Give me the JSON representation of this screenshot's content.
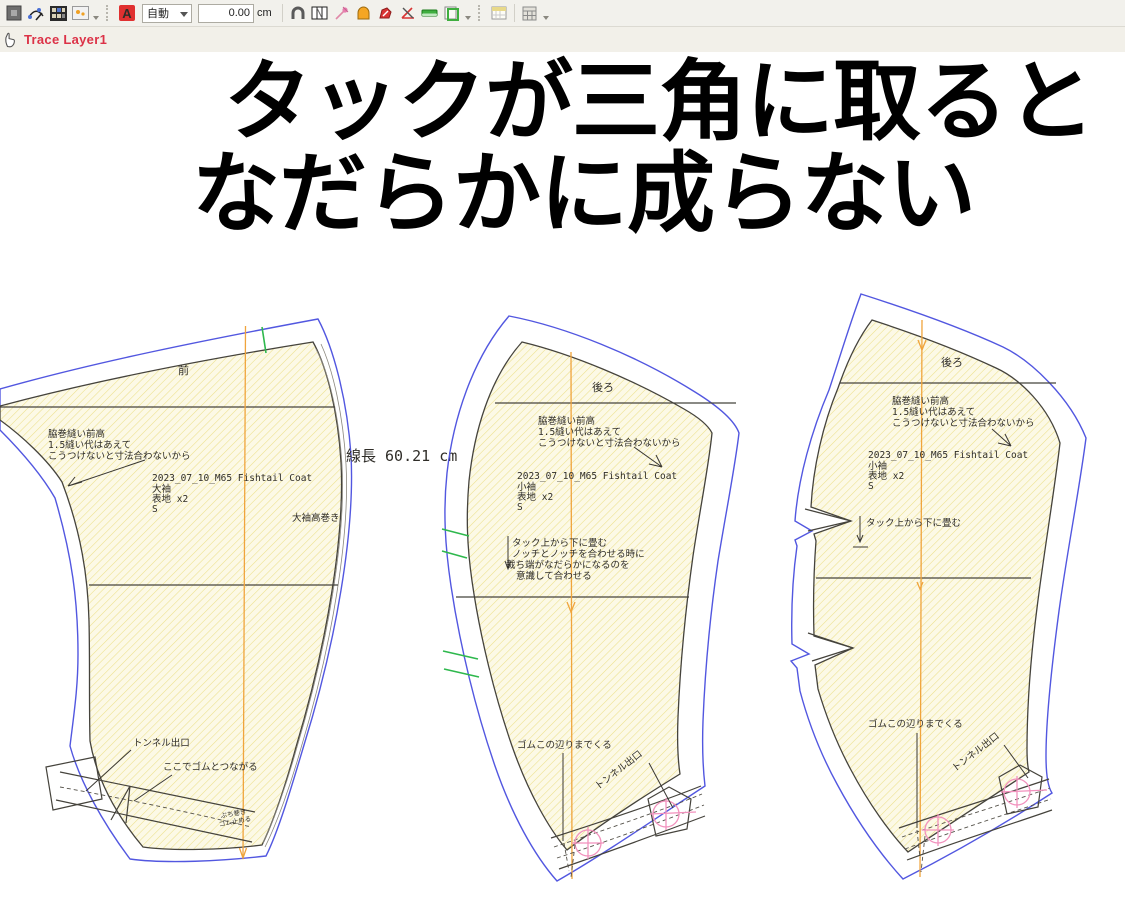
{
  "toolbar": {
    "combo_value": "自動",
    "field_value": "0.00",
    "unit": "cm",
    "icons": [
      "swatch-icon",
      "compass-icon",
      "grid-icon",
      "image-icon",
      "text-style-icon",
      "magnet-icon",
      "pleat-icon",
      "pin-icon",
      "dome-icon",
      "trace-icon",
      "angle-icon",
      "ruler-icon",
      "clipboard-icon",
      "calendar-icon",
      "calculator-icon"
    ]
  },
  "layer_bar": {
    "label": "Trace Layer1"
  },
  "caption": {
    "line1": "タックが三角に取ると",
    "line2": "なだらかに成らない"
  },
  "measurement": {
    "line_length": "線長 60.21 cm"
  },
  "pieces": {
    "piece1": {
      "part": "前",
      "note": [
        "脇巻縫い前高",
        "1.5縫い代はあえて",
        "こうつけないと寸法合わないから"
      ],
      "meta": [
        "2023_07_10_M65 Fishtail Coat",
        "大袖",
        "表地 x2",
        "S"
      ],
      "side": "大袖高巻き",
      "tunnel": "トンネル出口",
      "elastic": "ここでゴムとつながる",
      "tiny": [
        "ぶち巻き",
        "ゴム止める"
      ]
    },
    "piece2": {
      "part": "後ろ",
      "note": [
        "脇巻縫い前高",
        "1.5縫い代はあえて",
        "こうつけないと寸法合わないから"
      ],
      "meta": [
        "2023_07_10_M65 Fishtail Coat",
        "小袖",
        "表地 x2",
        "S"
      ],
      "tack": [
        "タック上から下に畳む",
        "ノッチとノッチを合わせる時に",
        "裁ち端がなだらかになるのを",
        "意識して合わせる"
      ],
      "elastic": "ゴムこの辺りまでくる",
      "tunnel": "トンネル出口"
    },
    "piece3": {
      "part": "後ろ",
      "note": [
        "脇巻縫い前高",
        "1.5縫い代はあえて",
        "こうつけないと寸法合わないから"
      ],
      "meta": [
        "2023_07_10_M65 Fishtail Coat",
        "小袖",
        "表地 x2",
        "S"
      ],
      "tack": "タック上から下に畳む",
      "elastic": "ゴムこの辺りまでくる",
      "tunnel": "トンネル出口"
    }
  },
  "colors": {
    "outer_contour": "#5257e0",
    "inner_contour": "#45433c",
    "pattern_fill": "#fcf9e6",
    "hatch_line": "#ece089",
    "grain_line": "#f0a43c",
    "notch_green": "#2eb84d",
    "marker_pink": "#f291bd",
    "layer_red": "#dc3247"
  }
}
